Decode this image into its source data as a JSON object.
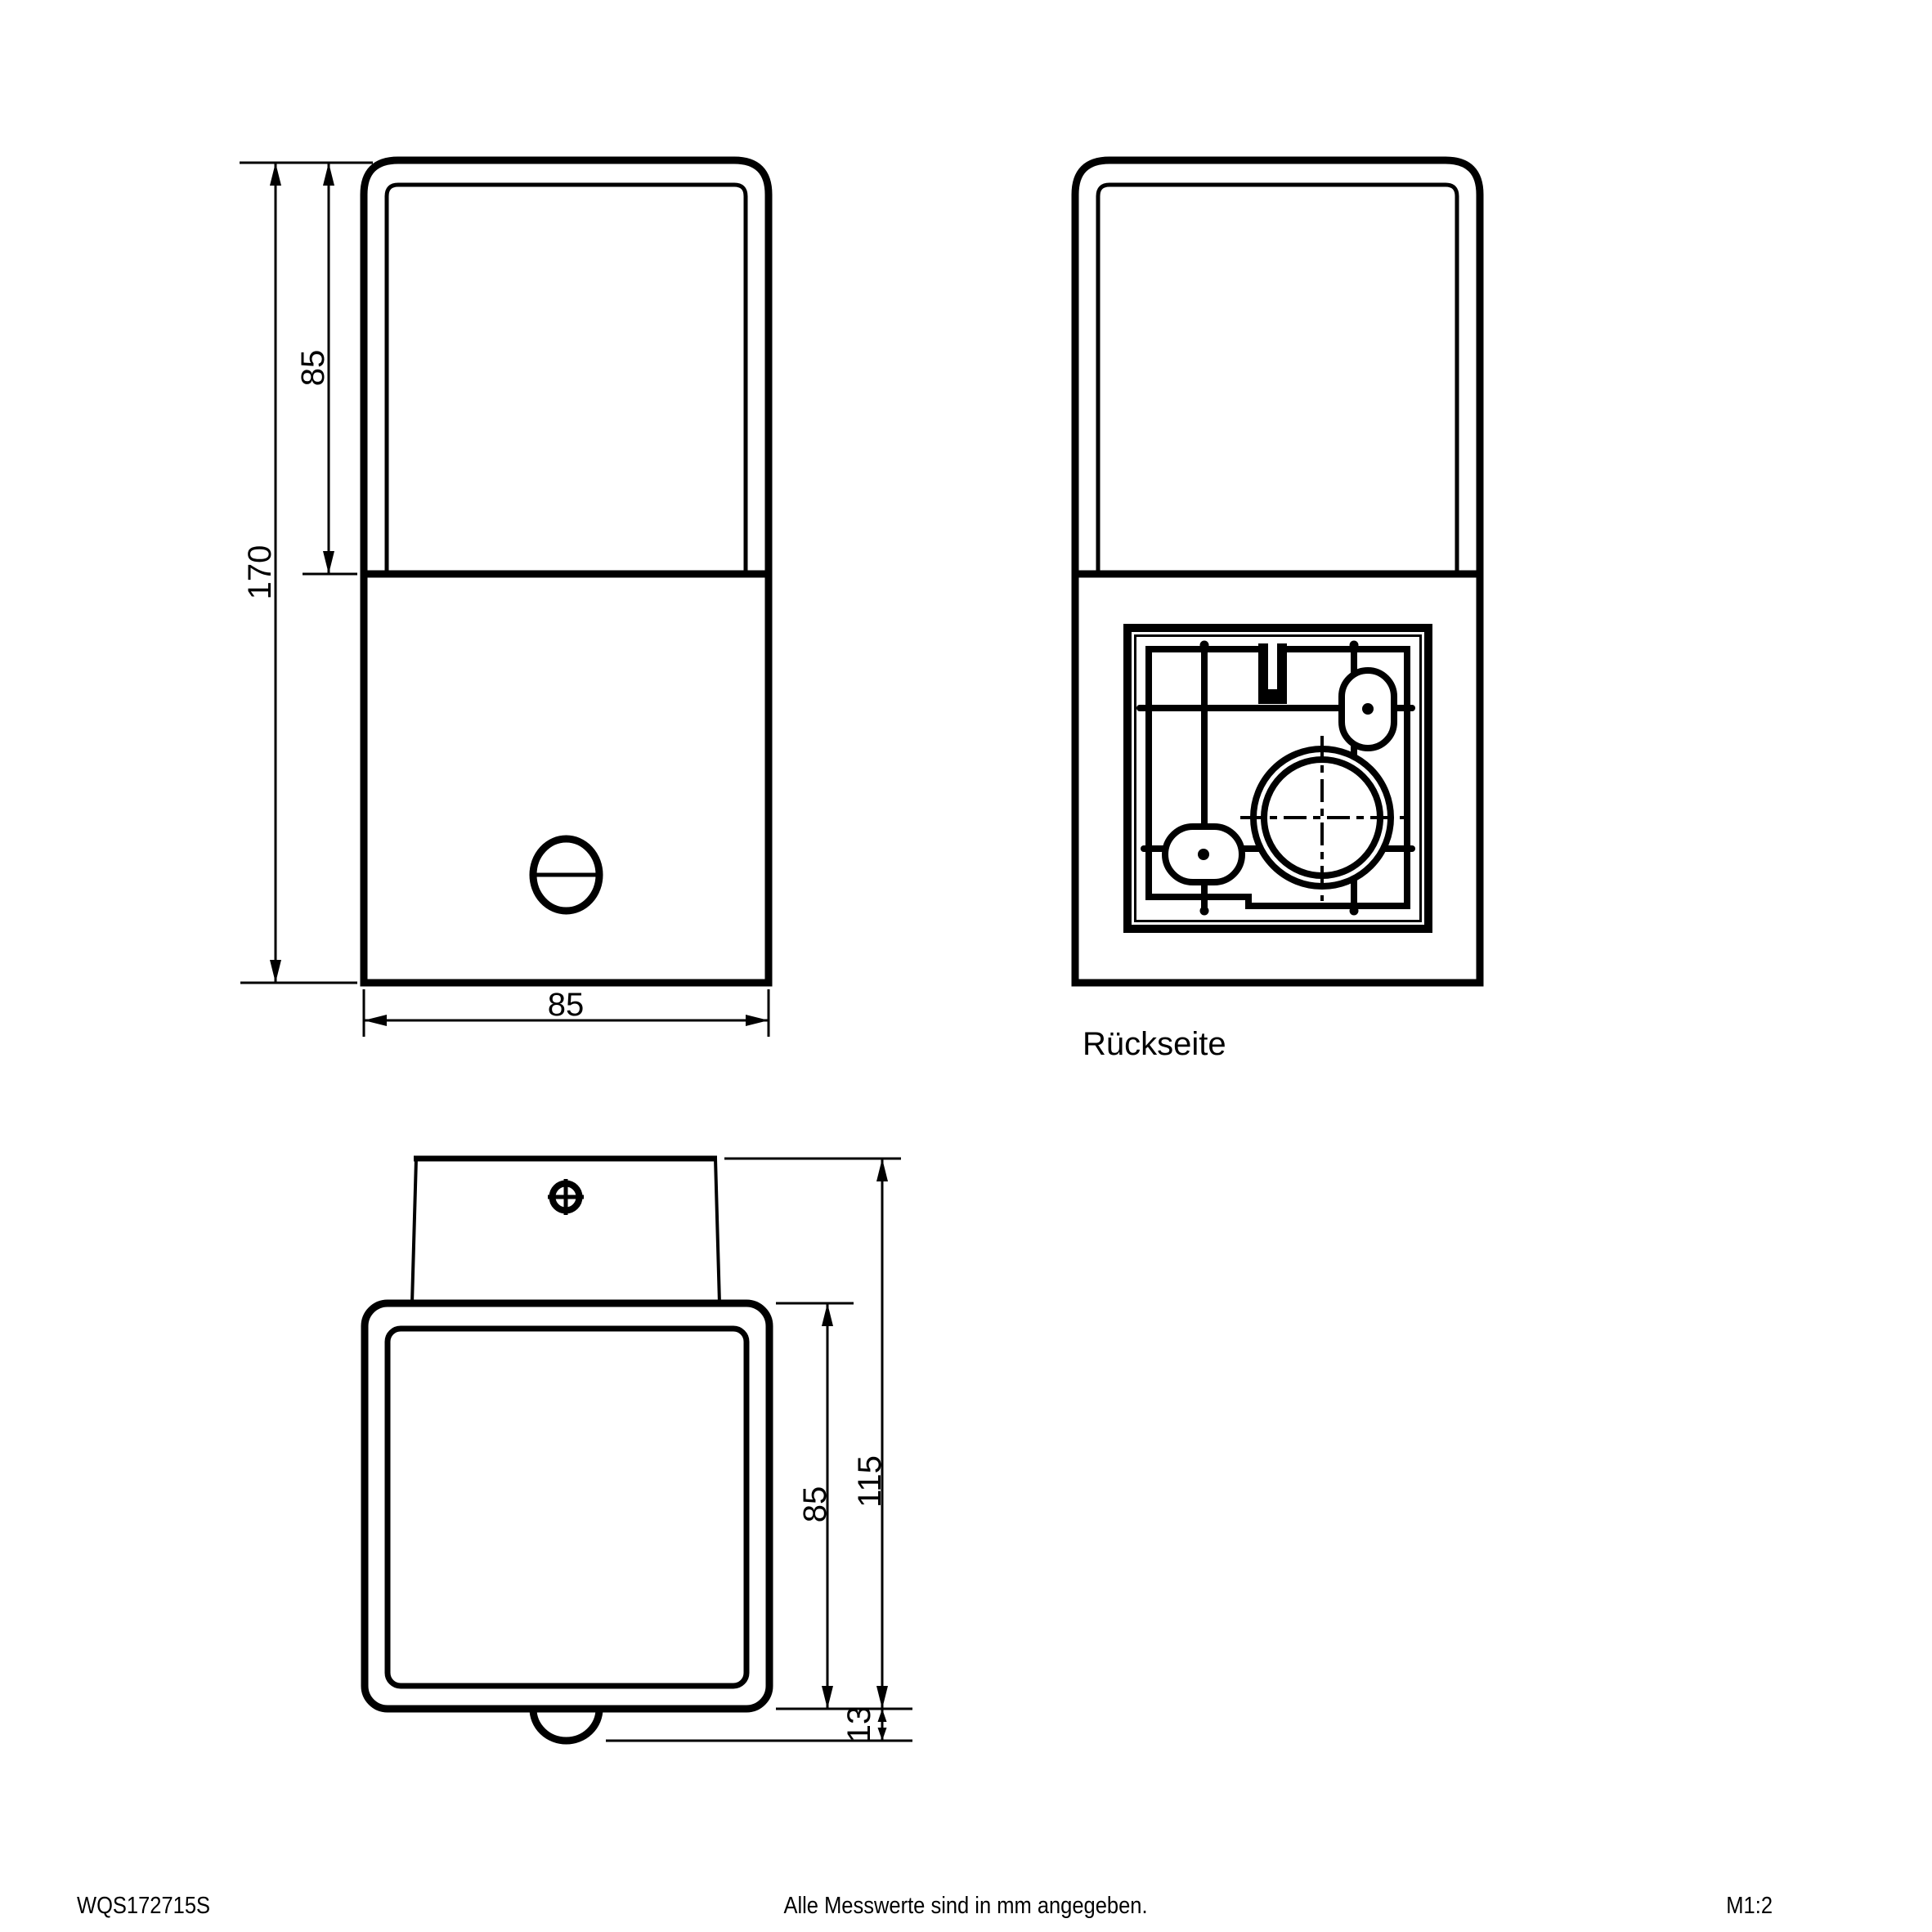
{
  "page": {
    "background_color": "#ffffff",
    "line_color": "#000000"
  },
  "front_view": {
    "dim_total_height": "170",
    "dim_lens_height": "85",
    "dim_width": "85"
  },
  "back_view": {
    "caption": "Rückseite"
  },
  "top_view": {
    "dim_body_depth": "85",
    "dim_total_depth": "115",
    "dim_sensor_depth": "13"
  },
  "footer": {
    "article_number": "WQS172715S",
    "note": "Alle Messwerte sind in mm angegeben.",
    "scale": "M1:2"
  }
}
